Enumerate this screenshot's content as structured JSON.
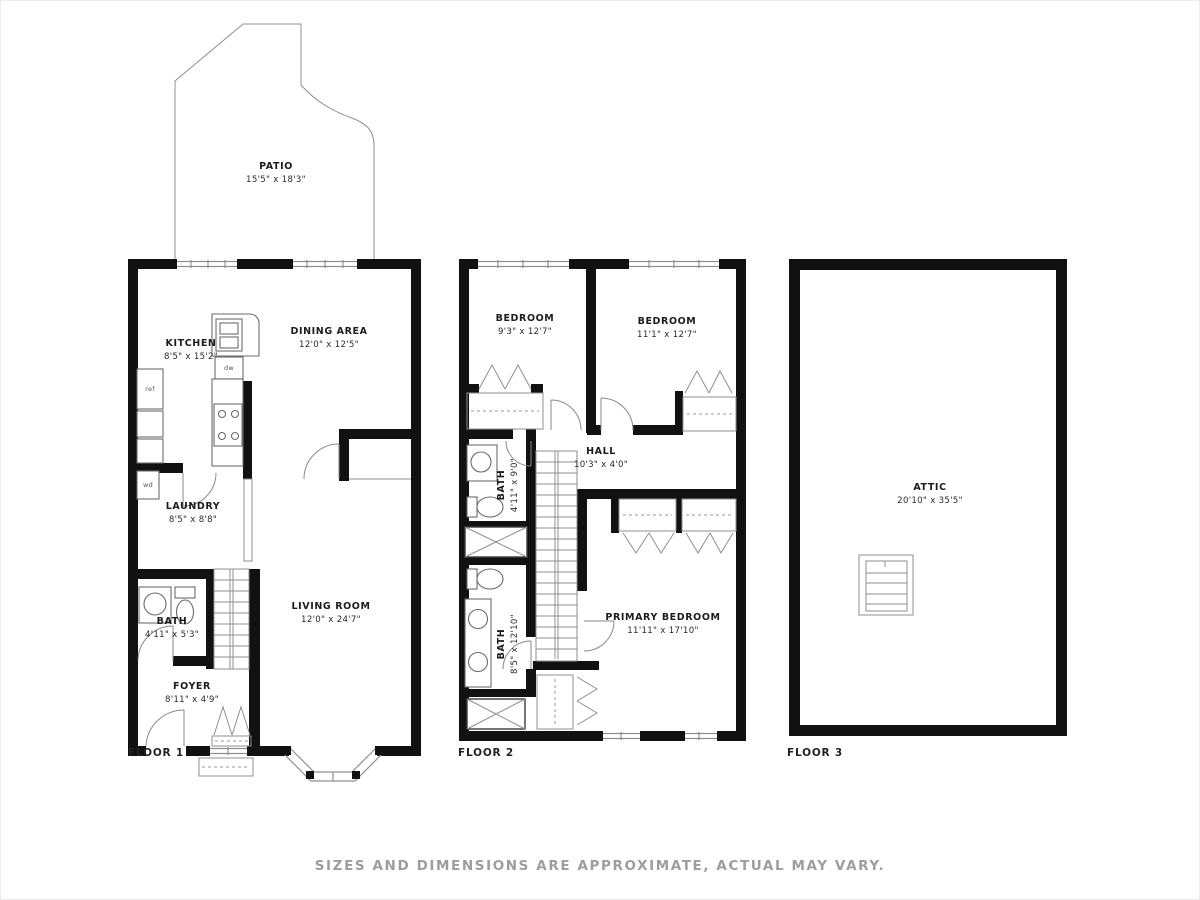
{
  "image": {
    "disclaimer": "SIZES AND DIMENSIONS ARE APPROXIMATE, ACTUAL MAY VARY.",
    "wall_color": "#111111",
    "background": "#ffffff"
  },
  "floor1": {
    "label": "FLOOR 1",
    "rooms": {
      "patio": {
        "name": "PATIO",
        "dims": "15'5\" x 18'3\""
      },
      "kitchen": {
        "name": "KITCHEN",
        "dims": "8'5\" x 15'2\""
      },
      "dining": {
        "name": "DINING AREA",
        "dims": "12'0\" x 12'5\""
      },
      "laundry": {
        "name": "LAUNDRY",
        "dims": "8'5\" x 8'8\""
      },
      "bath": {
        "name": "BATH",
        "dims": "4'11\" x 5'3\""
      },
      "living": {
        "name": "LIVING ROOM",
        "dims": "12'0\" x 24'7\""
      },
      "foyer": {
        "name": "FOYER",
        "dims": "8'11\" x 4'9\""
      }
    },
    "fixtures": {
      "ref": "ref",
      "dw": "dw",
      "wd": "wd"
    }
  },
  "floor2": {
    "label": "FLOOR 2",
    "rooms": {
      "bedroom_left": {
        "name": "BEDROOM",
        "dims": "9'3\" x 12'7\""
      },
      "bedroom_right": {
        "name": "BEDROOM",
        "dims": "11'1\" x 12'7\""
      },
      "hall": {
        "name": "HALL",
        "dims": "10'3\" x 4'0\""
      },
      "bath_upper": {
        "name": "BATH",
        "dims": "4'11\" x 9'0\""
      },
      "bath_lower": {
        "name": "BATH",
        "dims": "8'5\" x 12'10\""
      },
      "primary": {
        "name": "PRIMARY BEDROOM",
        "dims": "11'11\" x 17'10\""
      }
    }
  },
  "floor3": {
    "label": "FLOOR 3",
    "rooms": {
      "attic": {
        "name": "ATTIC",
        "dims": "20'10\" x 35'5\""
      }
    }
  }
}
